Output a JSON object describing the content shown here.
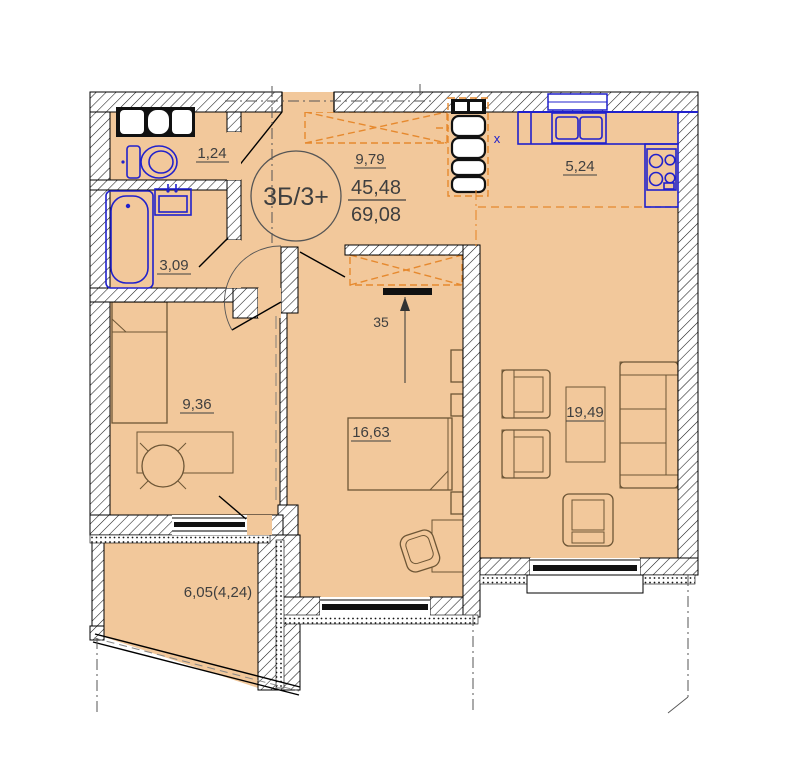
{
  "plan": {
    "unit": {
      "type_label": "3Б/3+",
      "living_area": "45,48",
      "total_area": "69,08"
    },
    "rooms": {
      "wc": "1,24",
      "bathroom": "3,09",
      "bedroom_small": "9,36",
      "hallway": "9,79",
      "kitchen": "5,24",
      "bedroom_master": "16,63",
      "living_room": "19,49",
      "balcony": "6,05(4,24)"
    },
    "marks": {
      "dimension_mark": "35",
      "washer_mark": "x"
    },
    "colors": {
      "floor_fill": "#f2c89b",
      "fixtures_blue": "#2121cc",
      "wardrobe_orange": "#e6892e",
      "wall_black": "#000000"
    }
  }
}
